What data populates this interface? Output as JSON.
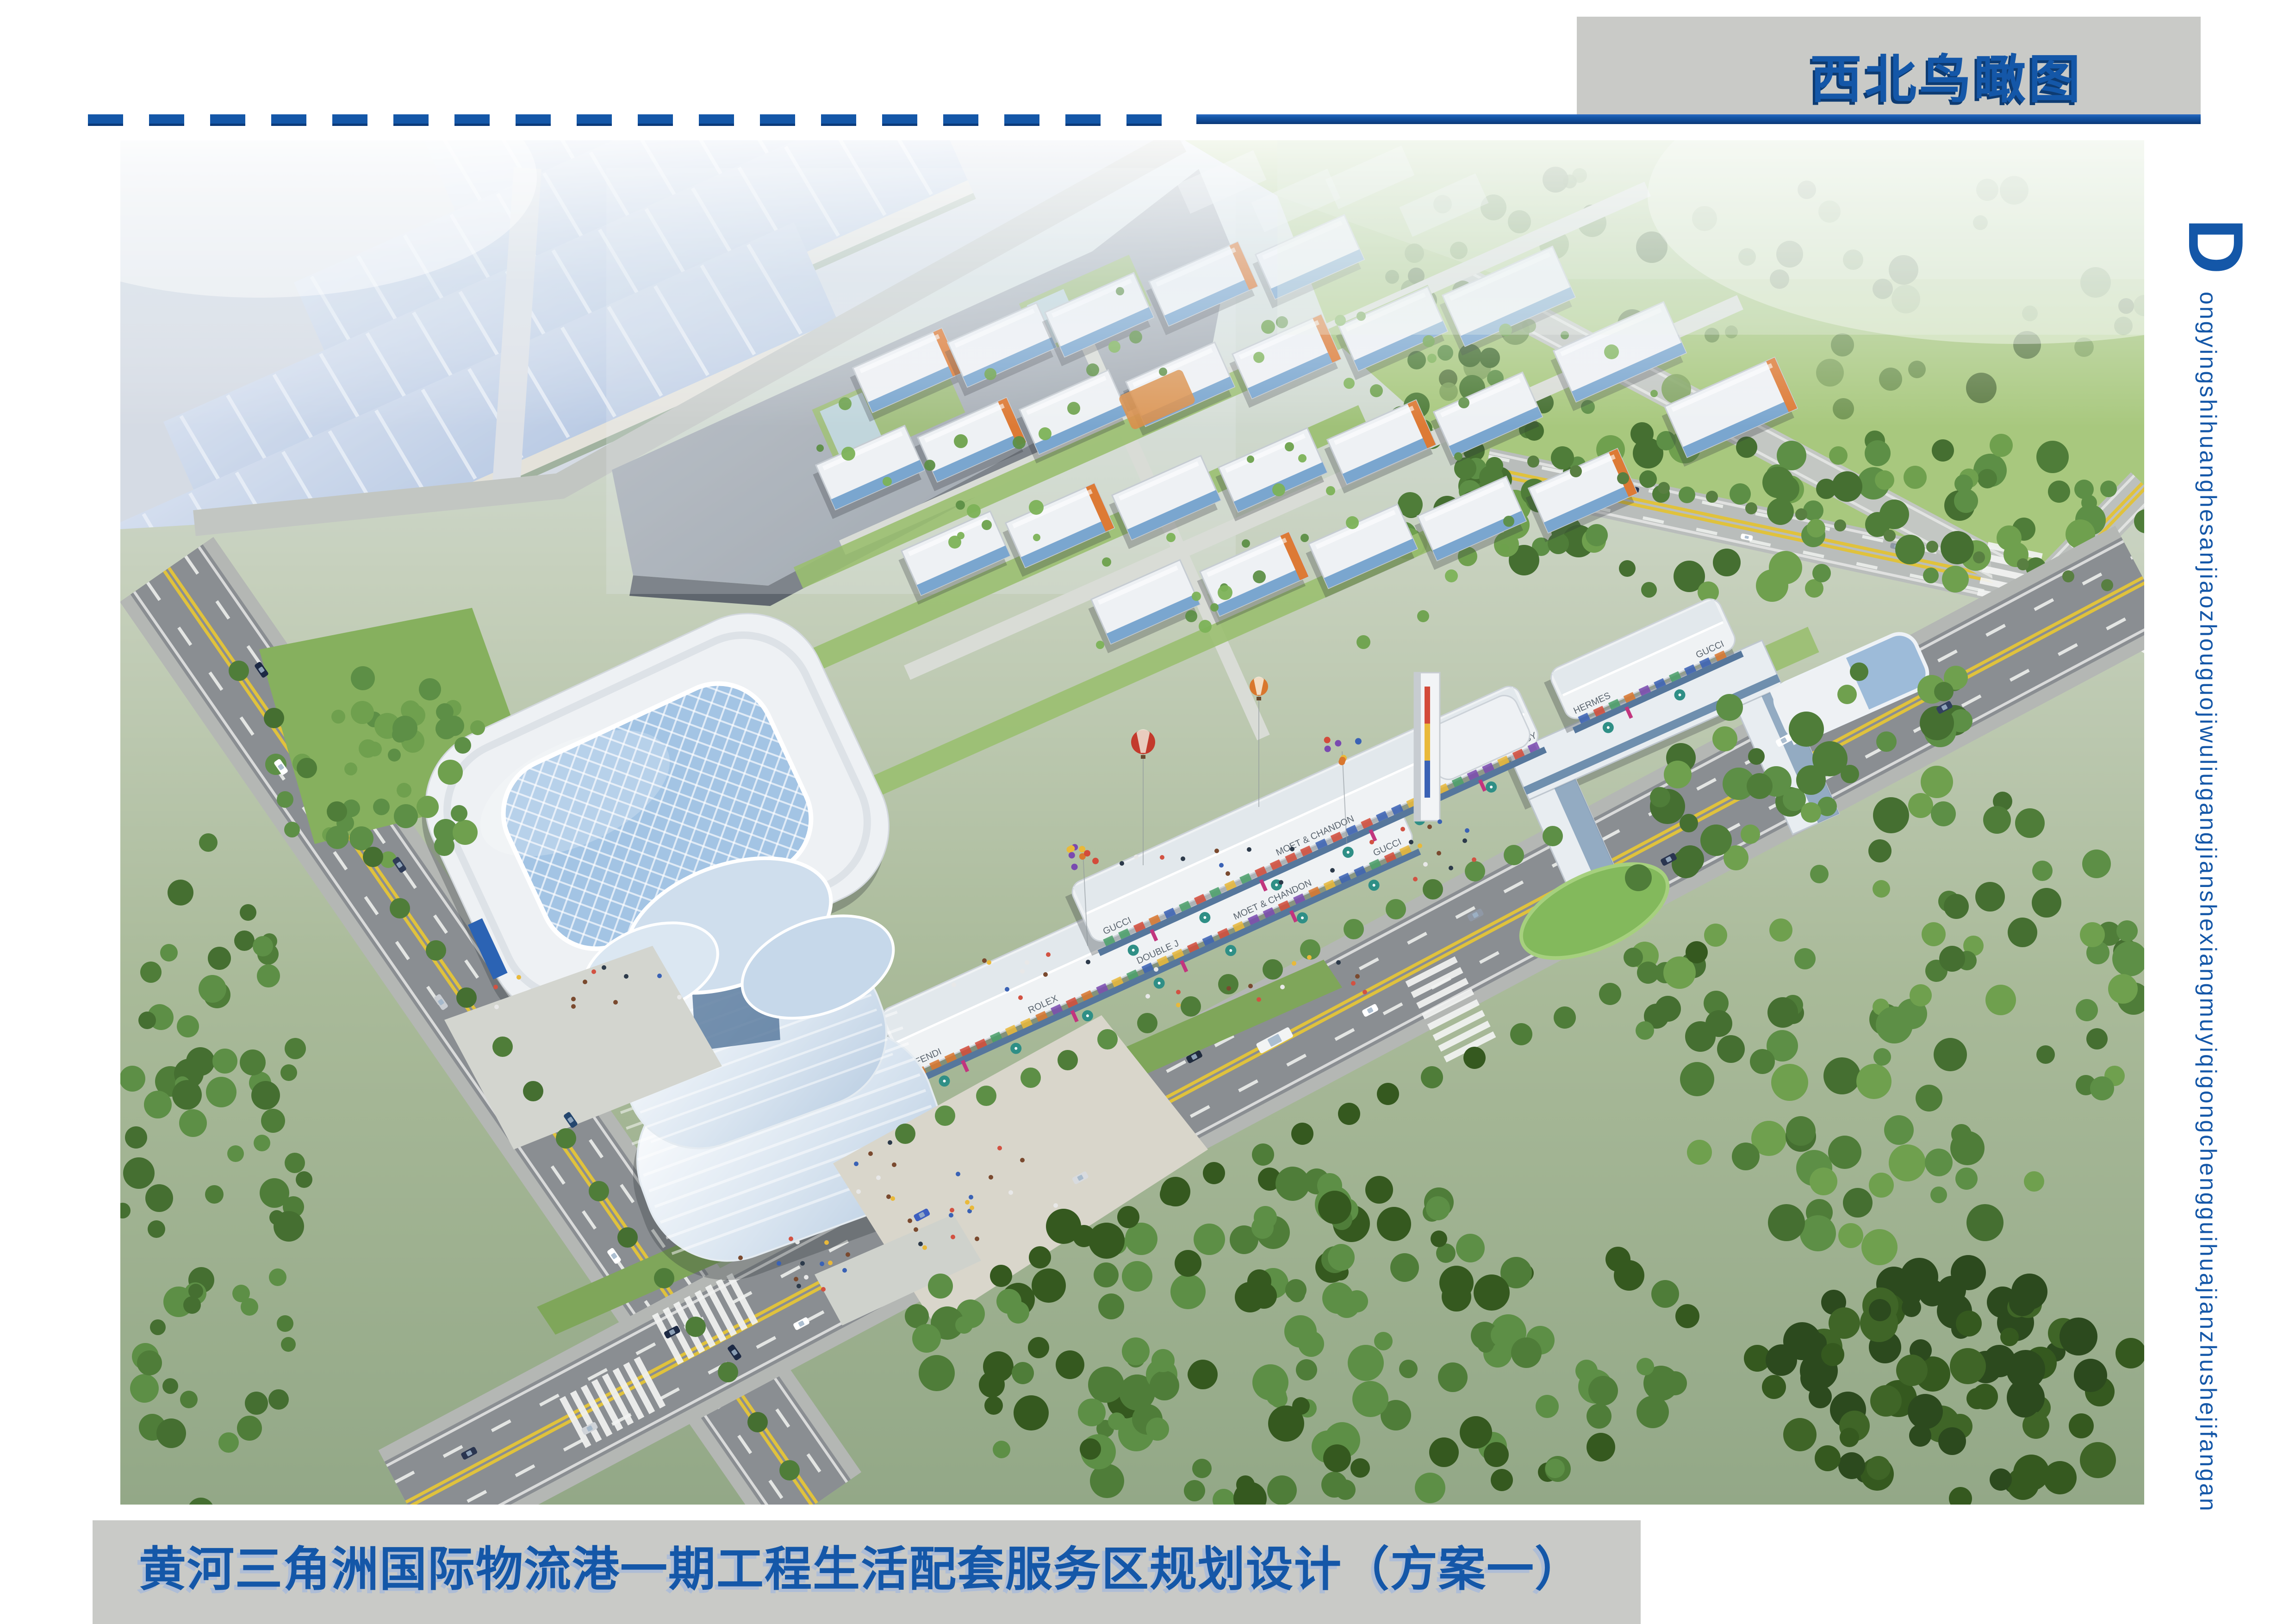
{
  "header": {
    "title": "西北鸟瞰图"
  },
  "side": {
    "initial": "D",
    "text": "ongyingshihuanghesanjiaozhouguojiwuliugangjianshexiangmuyiqigongchengguihuajianzhushejifangan"
  },
  "footer": {
    "title": "黄河三角洲国际物流港一期工程生活配套服务区规划设计（方案一）"
  },
  "signs": {
    "strip_a": [
      "FENDI",
      "ROLEX",
      "DOUBLE J",
      "MOET & CHANDON",
      "GUCCI"
    ],
    "strip_b": [
      "GUCCI",
      "MOET & CHANDON",
      "HENNESSY"
    ],
    "strip_c": [
      "HERMES",
      "GUCCI"
    ]
  },
  "colors": {
    "accent_blue": "#1457a8",
    "accent_shadow": "#0d3b72",
    "banner_gray": "#c9cac7",
    "footer_text_shadow": "#aebdd6"
  }
}
